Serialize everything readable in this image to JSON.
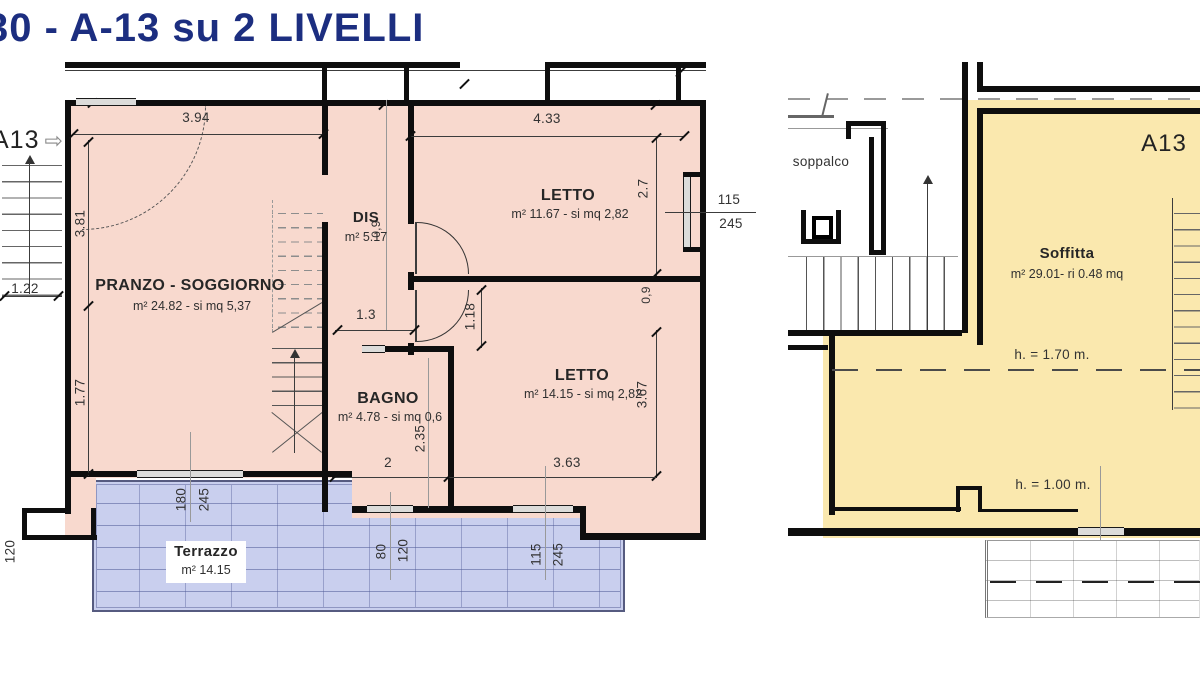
{
  "title": "30 - A-13 su 2 LIVELLI",
  "side_label": {
    "unit": "A13",
    "arrow": "⇨"
  },
  "colors": {
    "pink": "#f8d9ce",
    "terrace_blue": "#c9cfee",
    "attic_yellow": "#fae8ae",
    "title_navy": "#1c2e80",
    "wall": "#0e0e0e"
  },
  "plan1": {
    "rooms": {
      "soggiorno": {
        "name": "PRANZO - SOGGIORNO",
        "area": "m² 24.82 - si mq 5,37"
      },
      "dis": {
        "name": "DIS",
        "area": "m² 5.17"
      },
      "letto1": {
        "name": "LETTO",
        "area": "m² 11.67 - si mq 2,82"
      },
      "letto2": {
        "name": "LETTO",
        "area": "m² 14.15 - si mq 2,82"
      },
      "bagno": {
        "name": "BAGNO",
        "area": "m² 4.78 - si mq 0,6"
      },
      "terrazzo": {
        "name": "Terrazzo",
        "area": "m² 14.15"
      }
    },
    "dims": {
      "soggiorno_w": "3.94",
      "letto1_w": "4.33",
      "letto1_h": "2.7",
      "wall_left_upper": "3.81",
      "landing_w": "1.22",
      "wall_left_lower": "1.77",
      "parapet": "120",
      "dis_w": "1.3",
      "door_niche": "1.18",
      "door1_w": "0,9",
      "door2_w": "0,9",
      "bagno_h": "2.35",
      "bagno_w": "2",
      "letto2_w": "3.63",
      "letto2_h": "3.67",
      "win_letto1": {
        "w": "115",
        "h": "245"
      },
      "win_terrace": {
        "w": "180",
        "h": "245"
      },
      "win_bagno": {
        "w": "80",
        "h": "120"
      },
      "win_letto2": {
        "w": "115",
        "h": "245"
      }
    }
  },
  "plan2": {
    "labels": {
      "soppalco": "soppalco",
      "unit": "A13",
      "room": "Soffitta",
      "area": "m² 29.01- ri 0.48 mq",
      "height1": "h. = 1.70 m.",
      "height2": "h. = 1.00 m."
    },
    "dims": {
      "win_bottom": {
        "w": "80",
        "h": "60"
      }
    }
  }
}
